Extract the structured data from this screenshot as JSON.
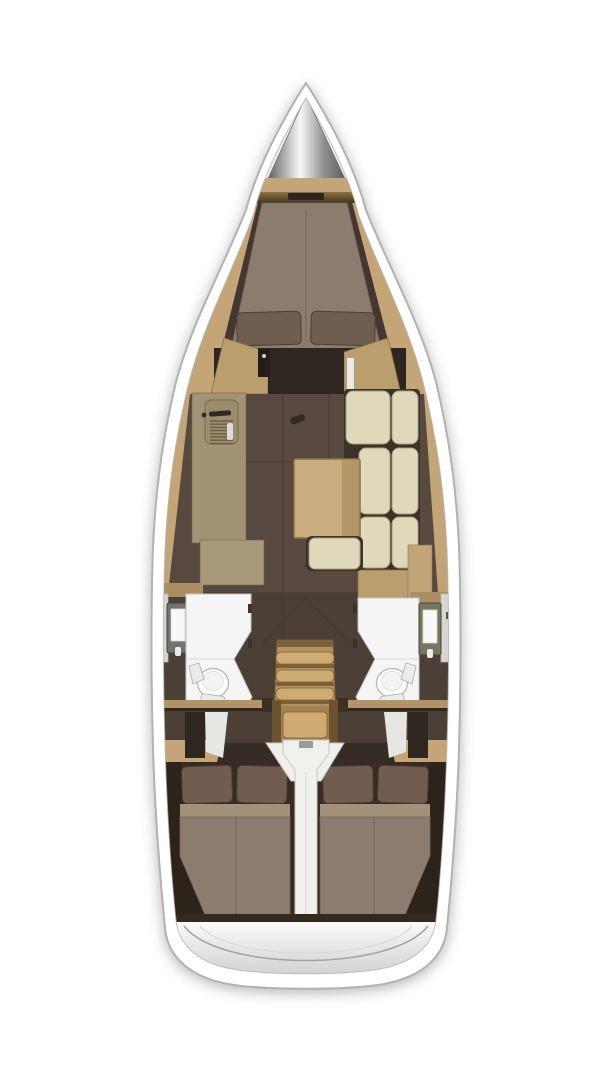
{
  "meta": {
    "title": "sailboat-interior-floor-plan",
    "view": "top-down",
    "visible_text": ""
  },
  "regions": [
    {
      "id": "bow-anchor-locker",
      "label": "bow anchor locker cone"
    },
    {
      "id": "vberth-cabin",
      "label": "forward V-berth cabin with double bed and two pillows"
    },
    {
      "id": "galley",
      "label": "port galley counter with sink and stove"
    },
    {
      "id": "salon-settee",
      "label": "starboard L-shaped settee with cream cushions"
    },
    {
      "id": "salon-table",
      "label": "salon table"
    },
    {
      "id": "salon-bench",
      "label": "center bench cushion"
    },
    {
      "id": "port-head",
      "label": "port bathroom with toilet, sink and vanity"
    },
    {
      "id": "starboard-head",
      "label": "starboard bathroom with toilet, sink and vanity"
    },
    {
      "id": "companionway-stairs",
      "label": "companionway steps"
    },
    {
      "id": "port-aft-cabin",
      "label": "port aft double cabin"
    },
    {
      "id": "starboard-aft-cabin",
      "label": "starboard aft double cabin"
    },
    {
      "id": "engine-divider",
      "label": "white center engine compartment divider"
    },
    {
      "id": "stern-platform",
      "label": "stern transom platform"
    }
  ],
  "palette": {
    "page_bg": "#ffffff",
    "hull_fill": "#ffffff",
    "hull_stroke": "#b2b2b0",
    "inner_stroke": "#b7b3ab",
    "deck_wood": "#c3a577",
    "deck_wood_dark": "#ab8e62",
    "bow_white": "#efefed",
    "cone_edge": "#6e6e6c",
    "cone_light": "#f8f8f8",
    "cone_mid": "#8f8f8f",
    "cone_dark": "#5e5e5e",
    "band_olive_top": "#8a7242",
    "band_olive_bottom": "#43361f",
    "band_slot": "#2b2620",
    "cabin_dark": "#443731",
    "mattress": "#8b7c6e",
    "mattress_seam": "#756659",
    "pillow": "#6f5d50",
    "pillow_stroke": "#4e3e33",
    "cabinet_wood": "#bb9e6e",
    "cabinet_stroke": "#8a7146",
    "door_dark": "#2e2621",
    "door_white": "#e9e9e6",
    "mast_dark": "#241e19",
    "salon_floor": "#574940",
    "floor_seam": "#463a30",
    "heads_floor": "#4c4036",
    "galley_counter": "#a29374",
    "galley_lower": "#a89a78",
    "galley_seam": "#6f6048",
    "sink_fill": "#9c8e6c",
    "sink_stroke": "#7f714f",
    "faucet_dark": "#2f2a22",
    "grate_line": "#6b5e44",
    "knob_white": "#dcdcd8",
    "cushion": "#e0d8ba",
    "cushion_stroke": "#a79d7f",
    "cushion_shadow": "#3a3128",
    "table_wood": "#c9ad7e",
    "table_stroke": "#8a7148",
    "table_leaf": "#b39768",
    "white_room": "#f4f5f4",
    "room_stroke": "#c5c6c4",
    "room_seam": "#d8dad8",
    "toilet_fill": "#fcfcfb",
    "toilet_stroke": "#b4b8b8",
    "toilet_inner": "#f2f4f4",
    "fixture_fill": "#eaece9",
    "fixture_stroke": "#b0b3b0",
    "vanity_left": "#6f7472",
    "vanity_right": "#787660",
    "vanity_stroke": "#45453f",
    "mirror_white": "#f7f8f7",
    "locker_light": "#d8d6ce",
    "locker_mark": "#55524a",
    "hinge_dark": "#3a332c",
    "stairs_wood": "#b2925f",
    "stairs_step": "#cdab72",
    "stairs_shadow": "#7c6138",
    "stairs_lower": "#a3814f",
    "stairs_rail": "#6b5330",
    "wedge_white": "#efefec",
    "rail_wood": "#b29468",
    "rail_dark": "#2f261d",
    "bracket_dark": "#3a3025",
    "aft_bg": "#372c23",
    "aft_wedge": "#2c231b",
    "bed_band": "#a39179",
    "bed_mattress": "#8c7c6e",
    "bed_pillow": "#705d4f",
    "patch_white": "#e6e6e2",
    "locker_dark": "#2f261f",
    "column_white": "#f0f0ed",
    "column_stroke": "#c6c6c3",
    "column_mark": "#9a9a97",
    "stern_strip": "#33291f",
    "stern_top": "#fafaf8",
    "stern_bottom": "#d2d2d0",
    "stern_curve": "#a3a3a1",
    "stern_curve_light": "#d8d8d6"
  }
}
